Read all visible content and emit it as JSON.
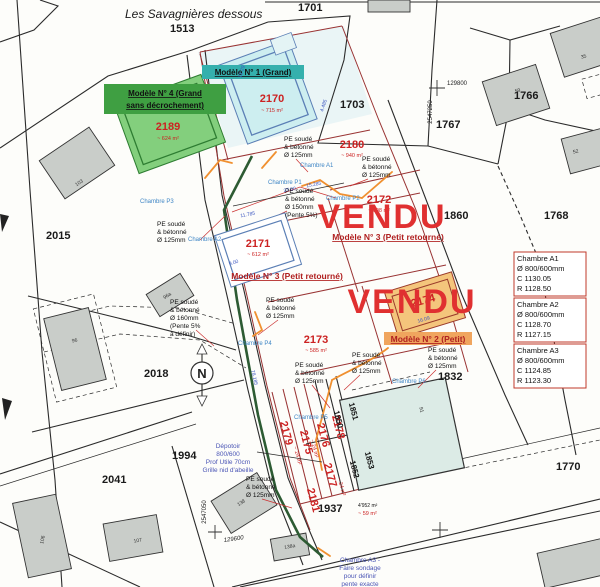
{
  "title": "Les Savagnières dessous",
  "vendu": "VENDU",
  "north": "N",
  "models": {
    "m1": "Modèle N° 1 (Grand)",
    "m4a": "Modèle N° 4 (Grand",
    "m4b": "sans décrochement)",
    "m3": "Modèle N° 3 (Petit retourné)",
    "m2": "Modèle N° 2 (Petit)"
  },
  "parcels": {
    "p1513": "1513",
    "p1701": "1701",
    "p1703": "1703",
    "p1767": "1767",
    "p1766": "1766",
    "p1860": "1860",
    "p1768": "1768",
    "p1770": "1770",
    "p2015": "2015",
    "p2018": "2018",
    "p1832": "1832",
    "p1994": "1994",
    "p2041": "2041",
    "p1937": "1937"
  },
  "p1937_areas": {
    "black": "4'952 m²",
    "red": "~ 59 m²"
  },
  "lots": {
    "l2189": {
      "num": "2189",
      "area": "~ 624 m²"
    },
    "l2170": {
      "num": "2170",
      "area": "~ 715 m²"
    },
    "l2180": {
      "num": "2180",
      "area": "~ 940 m²"
    },
    "l2172": {
      "num": "2172",
      "area": "~ 608 m²"
    },
    "l2171": {
      "num": "2171",
      "area": "~ 612 m²"
    },
    "l2173": {
      "num": "2173",
      "area": "~ 585 m²"
    },
    "l2174": {
      "num": "2174"
    },
    "strips": [
      "2179",
      "2175",
      "2176",
      "2178",
      "2177",
      "2181"
    ],
    "strip_area": "~ 24 m²",
    "bands": [
      "1850",
      "1851",
      "1852",
      "1853"
    ]
  },
  "pe": {
    "a": "PE soudé",
    "b": "& bétonné",
    "d125": "Ø 125mm",
    "d150": "Ø 150mm",
    "d160": "Ø 160mm",
    "p5": "(Pente 5%)",
    "p5a": "(Pente 5%",
    "p5b": "à définir)"
  },
  "chambres": {
    "p1": "Chambre P1",
    "p2": "Chambre P2",
    "p3": "Chambre P3",
    "p4": "Chambre P4",
    "p5": "Chambre P5",
    "p6": "Chambre P6",
    "a1": "Chambre A1",
    "a2": "Chambre A2"
  },
  "chamber_boxes": [
    {
      "name": "Chambre A1",
      "size": "Ø 800/600mm",
      "c": "C 1130.05",
      "r": "R 1128.50"
    },
    {
      "name": "Chambre A2",
      "size": "Ø 800/600mm",
      "c": "C 1128.70",
      "r": "R 1127.15"
    },
    {
      "name": "Chambre A3",
      "size": "Ø 800/600mm",
      "c": "C 1124.85",
      "r": "R 1123.30"
    }
  ],
  "depotoir": {
    "l1": "Dépotoir",
    "l2": "800/600",
    "l3": "Prof Utile 70cm",
    "l4": "Grille nid d'abeille"
  },
  "sondage": {
    "l1": "Chambre A3 -",
    "l2": "Faire sondage",
    "l3": "pour définir",
    "l4": "pente exacte"
  },
  "buildings": {
    "b59": "59",
    "b35": "35",
    "b52": "52",
    "b103": "103",
    "b96": "96",
    "b96a": "96a",
    "b91": "91",
    "b138": "138",
    "b138a": "138a",
    "b106": "106",
    "b107": "107"
  },
  "coords": {
    "top_e": "129800",
    "top_n": "2547250",
    "bot_n": "2547050",
    "bot_e": "129600"
  },
  "dims": {
    "d1": "27.00",
    "d2": "15.285",
    "d3": "11.785",
    "d4": "78.185",
    "d5": "12.29",
    "d6": "4.485",
    "d7": "16.09",
    "d8": "9.00"
  }
}
